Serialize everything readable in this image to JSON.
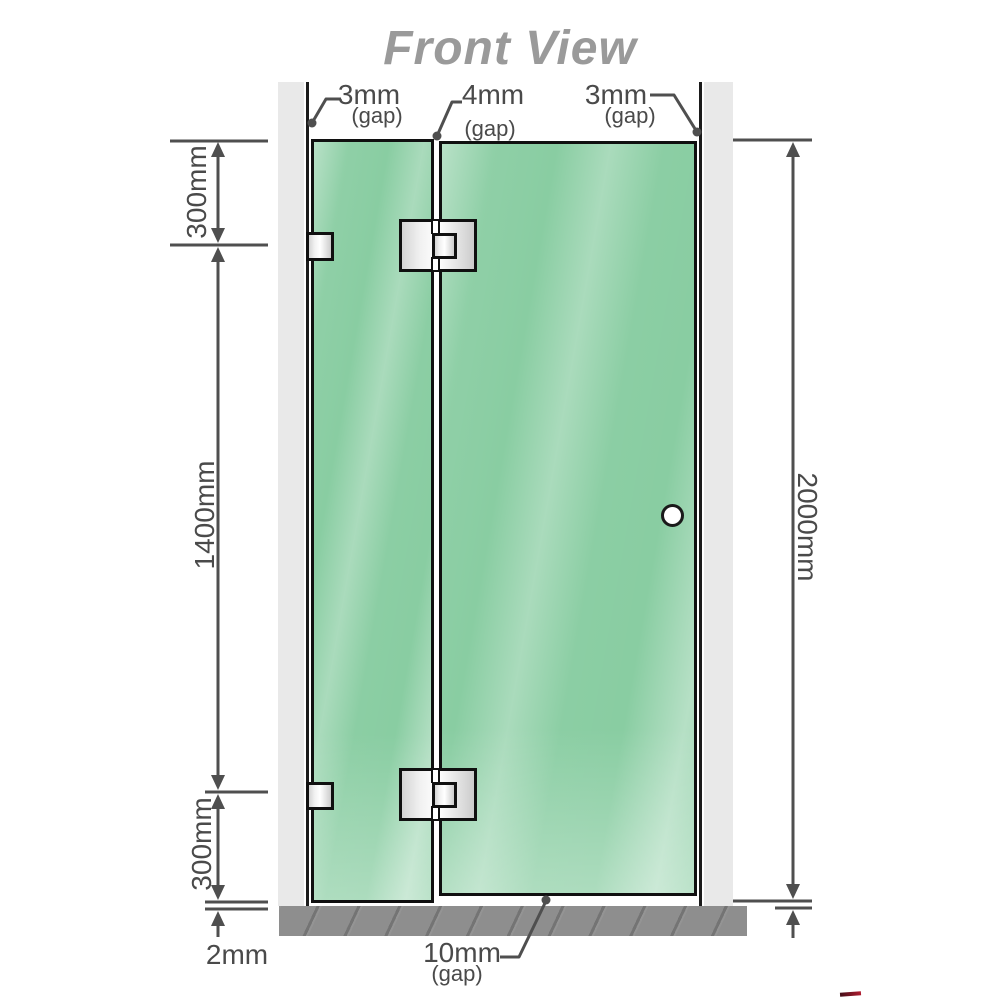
{
  "title": "Front View",
  "dimensions": {
    "gap_top_left": {
      "value": "3mm",
      "qualifier": "(gap)"
    },
    "gap_top_middle": {
      "value": "4mm",
      "qualifier": "(gap)"
    },
    "gap_top_right": {
      "value": "3mm",
      "qualifier": "(gap)"
    },
    "gap_bottom": {
      "value": "10mm",
      "qualifier": "(gap)"
    },
    "left_upper": "300mm",
    "left_middle": "1400mm",
    "left_lower": "300mm",
    "floor_gap": "2mm",
    "total_height": "2000mm"
  },
  "colors": {
    "glass_green": "#89cda2",
    "wall_gray": "#e9e9e9",
    "floor_gray": "#8e8e8e",
    "dimension_gray": "#4f4f4f",
    "title_gray": "#9a9a9a",
    "accent_red": "#b01c30"
  }
}
